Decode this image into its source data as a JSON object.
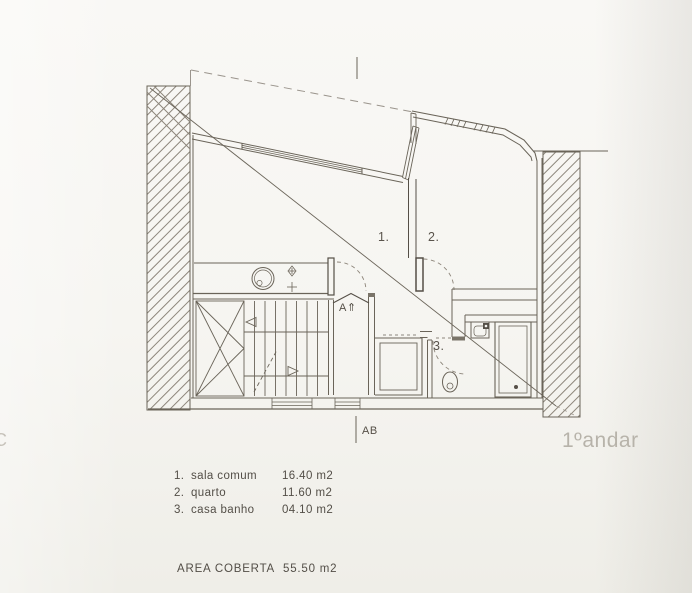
{
  "plan": {
    "floor_label": "1ºandar",
    "section_mark_bottom": "AB",
    "section_mark_up": "A⇑",
    "edge_letter": "C"
  },
  "rooms": [
    {
      "number": "1.",
      "name": "sala comum",
      "area": "16.40 m2"
    },
    {
      "number": "2.",
      "name": "quarto",
      "area": "11.60 m2"
    },
    {
      "number": "3.",
      "name": "casa banho",
      "area": "04.10 m2"
    }
  ],
  "legend": {
    "total_label": "AREA COBERTA",
    "total_value": "55.50 m2"
  },
  "colors": {
    "paper": "#f6f5f1",
    "ink": "#6a6459",
    "ink_dark": "#554f47",
    "hatch": "#8d867b",
    "dash": "#9a948c",
    "faint_text": "#b7b3aa",
    "legend_text": "#534e47"
  }
}
